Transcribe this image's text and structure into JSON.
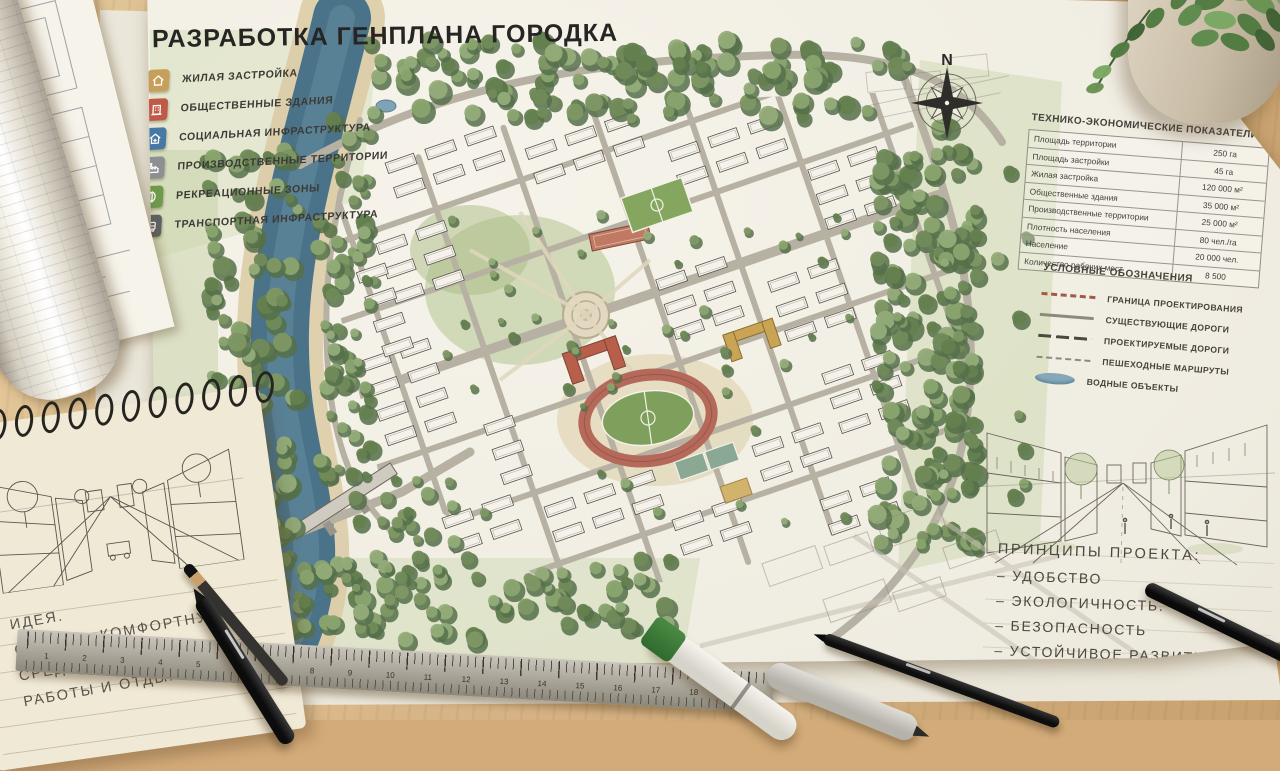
{
  "board_title": "РАЗРАБОТКА ГЕНПЛАНА ГОРОДКА",
  "compass": {
    "north": "N"
  },
  "zone_legend": {
    "items": [
      {
        "label": "ЖИЛАЯ ЗАСТРОЙКА",
        "color": "#c6a05a",
        "icon": "residential-icon"
      },
      {
        "label": "ОБЩЕСТВЕННЫЕ ЗДАНИЯ",
        "color": "#c05a47",
        "icon": "public-buildings-icon"
      },
      {
        "label": "СОЦИАЛЬНАЯ ИНФРАСТРУКТУРА",
        "color": "#4879a3",
        "icon": "social-infrastructure-icon"
      },
      {
        "label": "ПРОИЗВОДСТВЕННЫЕ ТЕРРИТОРИИ",
        "color": "#8d9093",
        "icon": "industrial-icon"
      },
      {
        "label": "РЕКРЕАЦИОННЫЕ ЗОНЫ",
        "color": "#6f9a4b",
        "icon": "recreation-icon"
      },
      {
        "label": "ТРАНСПОРТНАЯ ИНФРАСТРУКТУРА",
        "color": "#5f6365",
        "icon": "transport-icon"
      }
    ]
  },
  "indicators": {
    "title": "ТЕХНИКО-ЭКОНОМИЧЕСКИЕ ПОКАЗАТЕЛИ",
    "rows": [
      {
        "label": "Площадь территории",
        "value": "250 га"
      },
      {
        "label": "Площадь застройки",
        "value": "45 га"
      },
      {
        "label": "Жилая застройка",
        "value": "120 000 м²"
      },
      {
        "label": "Общественные здания",
        "value": "35 000 м²"
      },
      {
        "label": "Производственные территории",
        "value": "25 000 м²"
      },
      {
        "label": "Плотность населения",
        "value": "80 чел./га"
      },
      {
        "label": "Население",
        "value": "20 000 чел."
      },
      {
        "label": "Количество рабочих мест",
        "value": "8 500"
      }
    ]
  },
  "map_legend": {
    "title": "УСЛОВНЫЕ ОБОЗНАЧЕНИЯ",
    "items": [
      {
        "label": "ГРАНИЦА ПРОЕКТИРОВАНИЯ"
      },
      {
        "label": "СУЩЕСТВУЮЩИЕ ДОРОГИ"
      },
      {
        "label": "ПРОЕКТИРУЕМЫЕ ДОРОГИ"
      },
      {
        "label": "ПЕШЕХОДНЫЕ МАРШРУТЫ"
      },
      {
        "label": "ВОДНЫЕ ОБЪЕКТЫ"
      }
    ]
  },
  "principles": {
    "title": "ПРИНЦИПЫ ПРОЕКТА:",
    "items": [
      "– УДОБСТВО",
      "– ЭКОЛОГИЧНОСТЬ.",
      "– БЕЗОПАСНОСТЬ",
      "– УСТОЙЧИВОЕ РАЗВИТИЕ"
    ]
  },
  "notebook": {
    "lines": [
      "ИДЕЯ.",
      "СОЗДАТЬ КОМФОРТНУЮ",
      "СРЕДУ ДЛЯ ЖИЗНИ,",
      "РАБОТЫ И ОТДЫХА"
    ]
  },
  "ruler": {
    "numbers": [
      1,
      2,
      3,
      4,
      5,
      6,
      7,
      8,
      9,
      10,
      11,
      12,
      13,
      14,
      15,
      16,
      17,
      18,
      19
    ]
  },
  "colors": {
    "desk": "#d3ab79",
    "paper": "#f2efe8",
    "river": "#4a7389",
    "stadium_track": "#b4695a",
    "stadium_field": "#7ea05c",
    "forest": "#7b9461",
    "road": "#b7b1a3",
    "red_roof": "#b85f4b",
    "tan_roof": "#c9a455"
  }
}
